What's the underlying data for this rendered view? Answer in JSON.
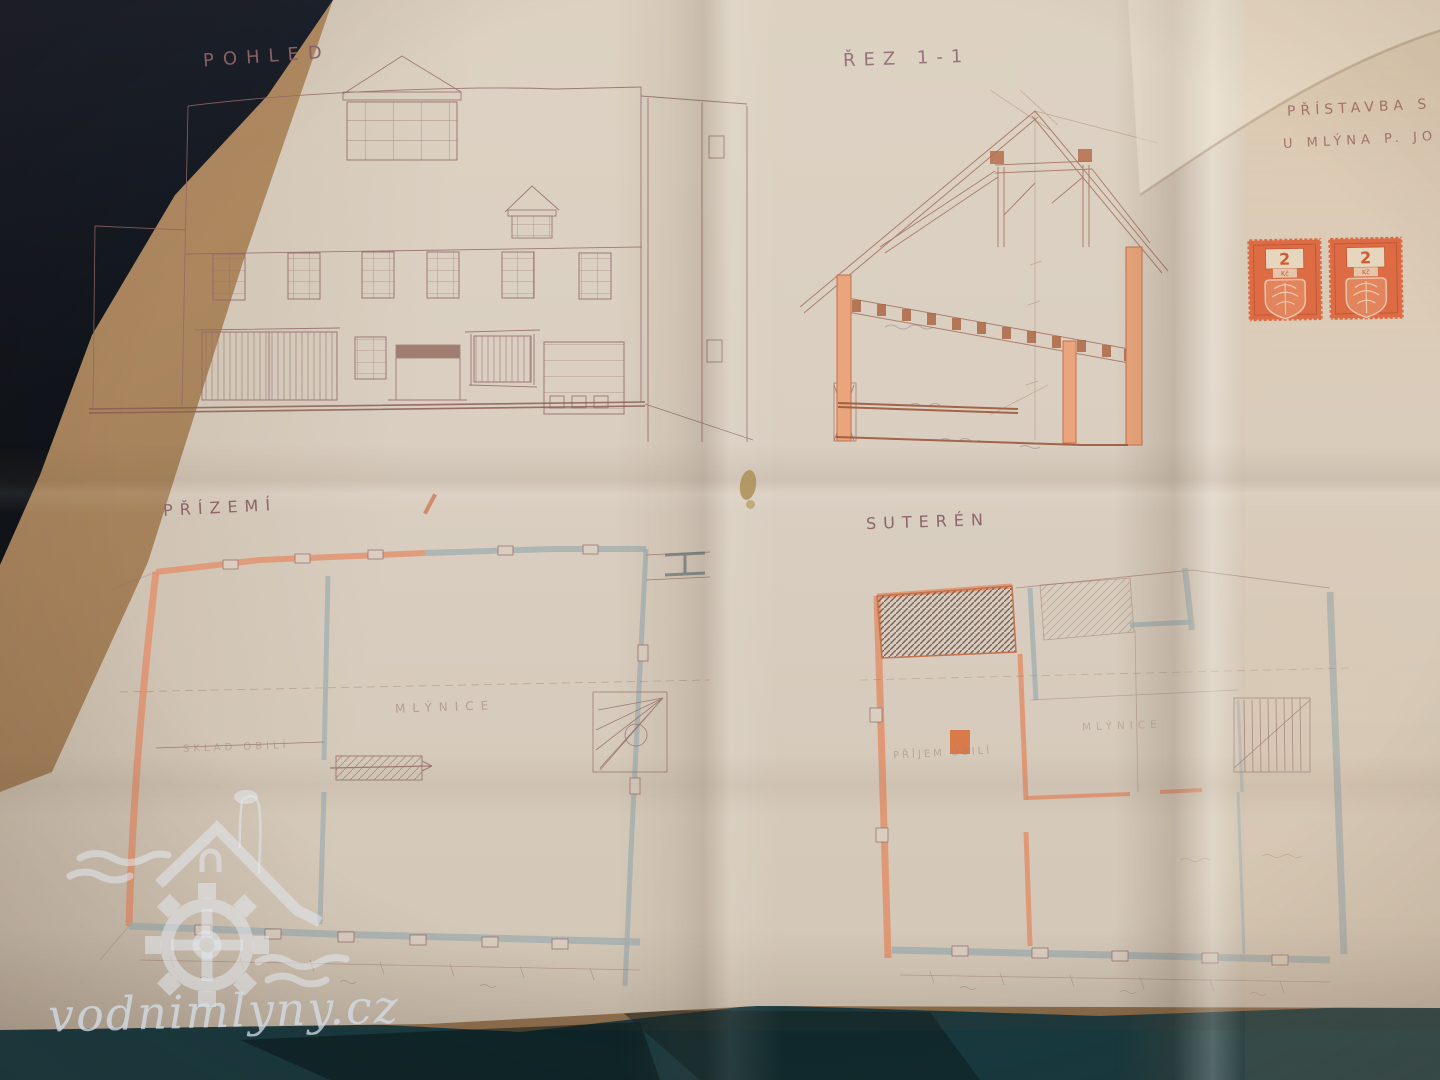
{
  "watermark": {
    "site": "vodnimlyny.cz"
  },
  "titles": {
    "project_line1": "PŘÍSTAVBA S",
    "project_line2": "U MLÝNA P. JO",
    "elevation": "POHLED",
    "section": "ŘEZ 1-1",
    "ground_floor": "PŘÍZEMÍ",
    "basement": "SUTERÉN"
  },
  "rooms": {
    "gf_storage": "SKLAD OBILÍ",
    "gf_mill": "MLÝNICE",
    "bs_intake": "PŘÍJEM OBILÍ",
    "bs_mill": "MLÝNICE"
  },
  "stamps": {
    "value": "2",
    "currency": "Kč",
    "count": 2
  },
  "colors": {
    "paper": "#d9cec0",
    "pencil_ink": "#93686a",
    "wall_orange": "#e2906b",
    "wall_gray": "#a4b0b2",
    "stamp_orange": "#dd6b44",
    "desk_wood": "#a3805a",
    "table_front": "#16393f",
    "watermark_tint": "#dfe7ec"
  }
}
